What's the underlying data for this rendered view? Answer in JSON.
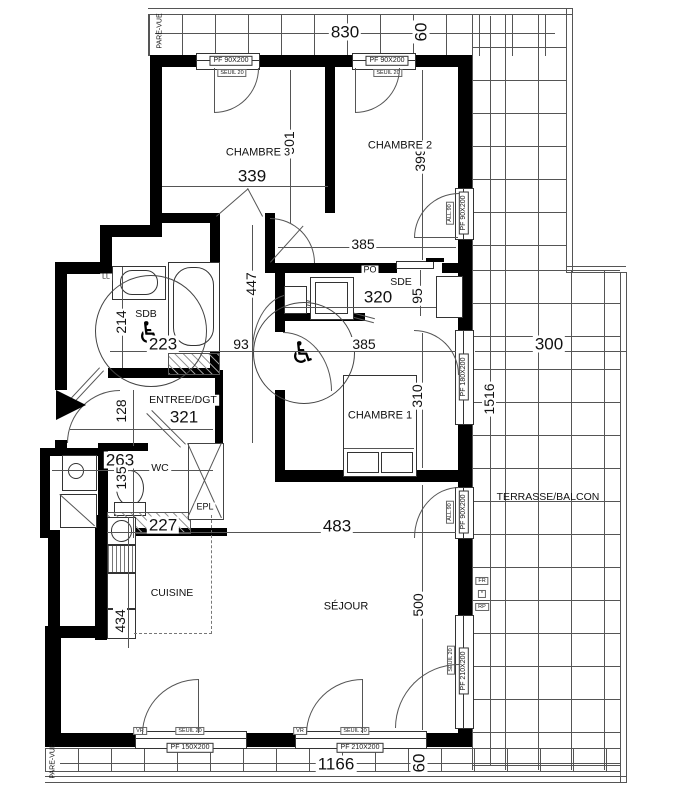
{
  "drawing": {
    "rooms": {
      "chambre3": "CHAMBRE 3",
      "chambre2": "CHAMBRE 2",
      "chambre1": "CHAMBRE 1",
      "sejour": "SÉJOUR",
      "cuisine": "CUISINE",
      "sdb": "SDB",
      "sde": "SDE",
      "wc": "WC",
      "epl": "EPL",
      "entree": "ENTREE/DGT",
      "terrasse": "TERRASSE/BALCON"
    },
    "tags": {
      "pare_vue": "PARE-VUE",
      "ll": "LL",
      "po": "PO",
      "vr": "VR",
      "fr": "FR",
      "star": "*",
      "rp": "RP"
    },
    "windows": {
      "pf90": "PF 90X200",
      "pf150": "PF 150X200",
      "pf180": "PF 180X200",
      "pf210": "PF 210X200",
      "seuil": "SEUIL 20",
      "allege": "ALL.90"
    },
    "dims": {
      "t830": "830",
      "t60": "60",
      "c3w": "339",
      "c3h": "301",
      "c2h": "399",
      "up385": "385",
      "hall447": "447",
      "sde320": "320",
      "sde95": "95",
      "sdb214": "214",
      "sdb223": "223",
      "d93": "93",
      "c1w": "385",
      "c1h": "310",
      "ter300": "300",
      "ter1516": "1516",
      "ent128": "128",
      "ent321": "321",
      "wc263": "263",
      "wc135": "135",
      "kw227": "227",
      "sj483": "483",
      "kh434": "434",
      "sjh500": "500",
      "b1166": "1166",
      "b60": "60"
    }
  }
}
